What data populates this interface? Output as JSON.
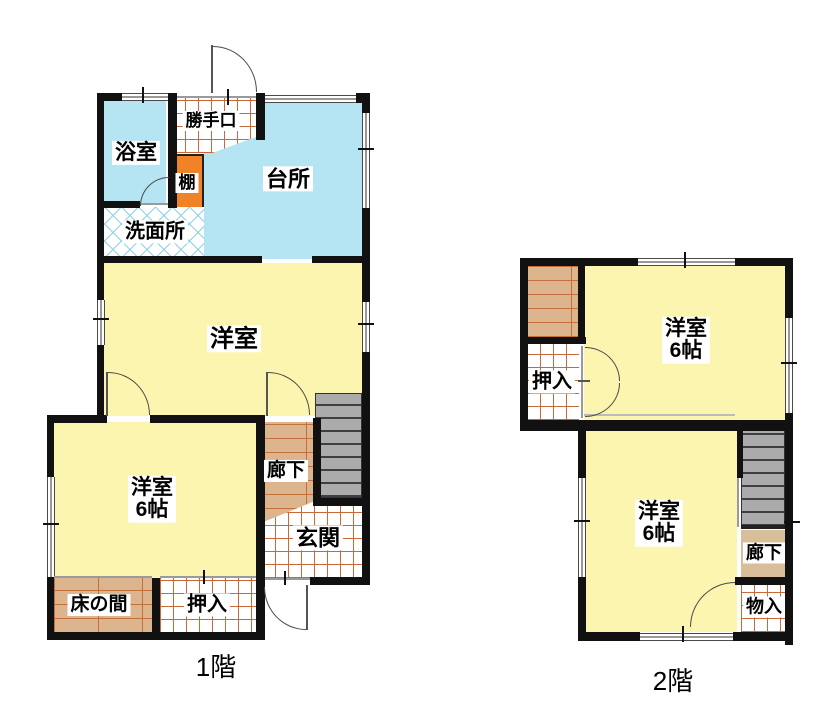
{
  "floor1": {
    "title": "1階",
    "rooms": {
      "bath": "浴室",
      "backdoor": "勝手口",
      "shelf": "棚",
      "kitchen": "台所",
      "washroom": "洗面所",
      "living": "洋室",
      "bedroom_name": "洋室",
      "bedroom_size": "6帖",
      "corridor": "廊下",
      "entrance": "玄関",
      "tokonoma": "床の間",
      "closet": "押入"
    }
  },
  "floor2": {
    "title": "2階",
    "rooms": {
      "closet": "押入",
      "bedroom_north_name": "洋室",
      "bedroom_north_size": "6帖",
      "bedroom_south_name": "洋室",
      "bedroom_south_size": "6帖",
      "corridor": "廊下",
      "storage": "物入"
    }
  },
  "colors": {
    "room_yellow": "#fbf5b0",
    "water_blue": "#b5e4f2",
    "tatami_tan": "#dcb58f",
    "grid_orange": "#c8693a",
    "shelf_orange": "#f08327",
    "stair_gray": "#ababab",
    "wall_black": "#111111"
  }
}
